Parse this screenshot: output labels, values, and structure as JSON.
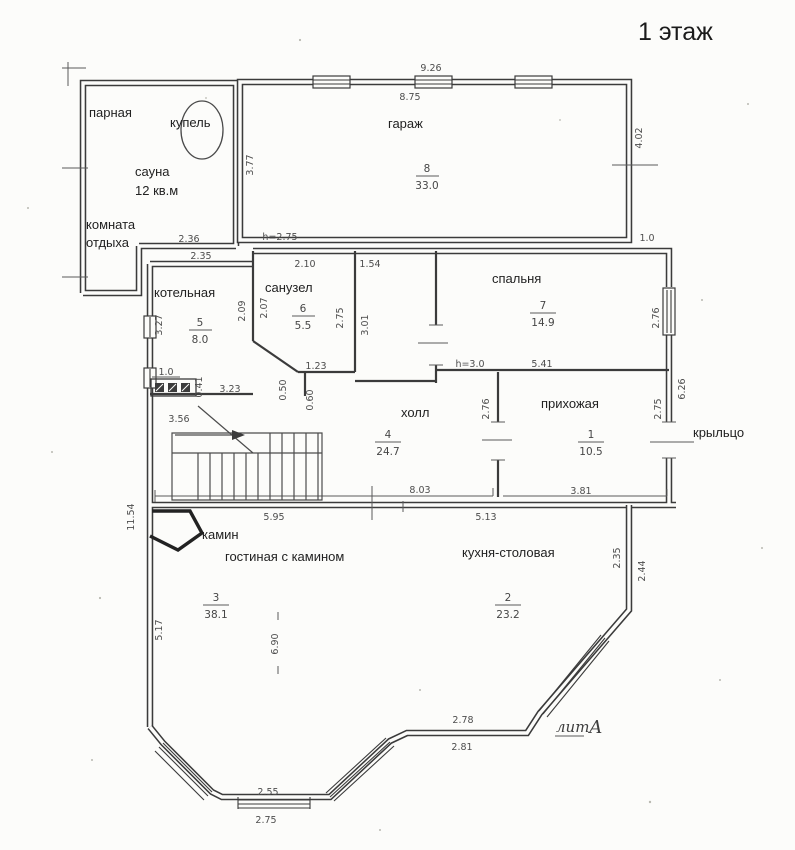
{
  "title": "1 этаж",
  "rooms": {
    "parnaya": {
      "label": "парная"
    },
    "kupel": {
      "label": "купель"
    },
    "sauna": {
      "label": "сауна",
      "note": "12 кв.м"
    },
    "otdyh": {
      "line1": "комната",
      "line2": "отдыха"
    },
    "garazh": {
      "label": "гараж",
      "num": "8",
      "area": "33.0",
      "height": "h=2.75"
    },
    "kotelnaya": {
      "label": "котельная",
      "num": "5",
      "area": "8.0"
    },
    "sanuzel": {
      "label": "санузел",
      "num": "6",
      "area": "5.5"
    },
    "spalnya": {
      "label": "спальня",
      "num": "7",
      "area": "14.9",
      "height": "h=3.0"
    },
    "holl": {
      "label": "холл",
      "num": "4",
      "area": "24.7"
    },
    "prihozhaya": {
      "label": "прихожая",
      "num": "1",
      "area": "10.5"
    },
    "kryltso": {
      "label": "крыльцо"
    },
    "kamin": {
      "label": "камин"
    },
    "gostinaya": {
      "label": "гостиная с камином",
      "num": "3",
      "area": "38.1"
    },
    "kuhnya": {
      "label": "кухня-столовая",
      "num": "2",
      "area": "23.2"
    },
    "lit": {
      "word": "лит",
      "letter": "А"
    }
  },
  "dims": {
    "garage_top_outer": "9.26",
    "garage_top_inner": "8.75",
    "garage_left": "3.77",
    "garage_right": "4.02",
    "garage_step": "1.0",
    "sauna_bottom": "2.36",
    "kotelnaya_top": "2.35",
    "kotelnaya_left": "3.27",
    "kotelnaya_right": "2.09",
    "kotelnaya_niche": "1.0",
    "kotelnaya_offset": "0.41",
    "kotelnaya_bottom": "3.23",
    "sanuzel_top": "2.10",
    "sanuzel_left": "2.07",
    "sanuzel_right": "2.75",
    "sanuzel_bottom": "1.23",
    "sanuzel_jog_a": "0.50",
    "sanuzel_jog_b": "0.60",
    "corridor_top": "1.54",
    "corridor_left": "3.01",
    "spalnya_window": "2.76",
    "spalnya_bottom": "5.41",
    "east_side": "6.26",
    "holl_door": "2.76",
    "prihozhaya_door": "2.75",
    "holl_bottom": "8.03",
    "prihozhaya_bottom": "3.81",
    "stairs_width": "3.56",
    "west_side": "11.54",
    "gostinaya_top": "5.95",
    "kuhnya_top": "5.13",
    "gostinaya_left": "5.17",
    "gostinaya_depth": "6.90",
    "kuhnya_east_inner": "2.35",
    "kuhnya_east_outer": "2.44",
    "bay_east_top": "2.78",
    "bay_east_bottom": "2.81",
    "bay_south_top": "2.55",
    "bay_south_bottom": "2.75"
  }
}
